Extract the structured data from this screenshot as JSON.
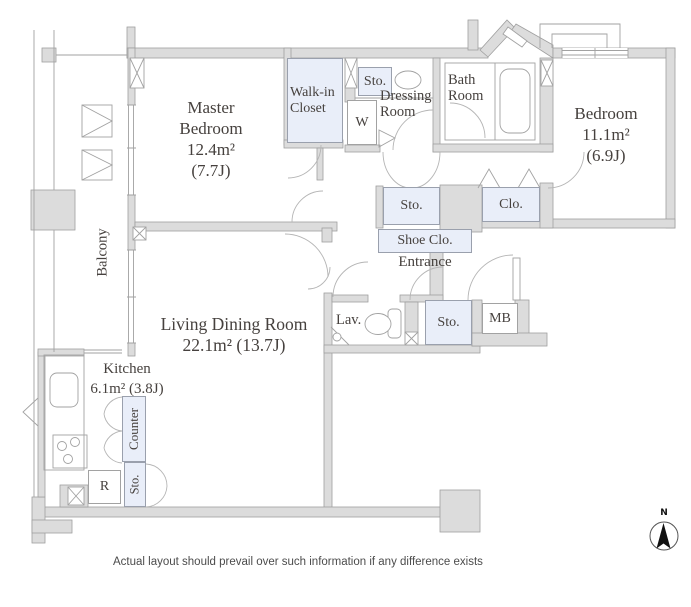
{
  "colors": {
    "wall_fill": "#dcdcdc",
    "wall_stroke": "#9f9f9f",
    "closet_fill": "#e9eef9",
    "line": "#a2a2a2",
    "text": "#46413e"
  },
  "rooms": {
    "master_bedroom": {
      "line1": "Master",
      "line2": "Bedroom",
      "area": "12.4m²",
      "tatami": "(7.7J)"
    },
    "bedroom": {
      "name": "Bedroom",
      "area": "11.1m²",
      "tatami": "(6.9J)"
    },
    "living_dining": {
      "name": "Living Dining Room",
      "area": "22.1m²  (13.7J)"
    },
    "kitchen": {
      "name": "Kitchen",
      "area": "6.1m²  (3.8J)"
    },
    "walk_in_closet": {
      "line1": "Walk-in",
      "line2": "Closet"
    },
    "dressing_room": {
      "line1": "Dressing",
      "line2": "Room"
    },
    "bath_room": {
      "line1": "Bath",
      "line2": "Room"
    },
    "balcony": {
      "name": "Balcony"
    },
    "entrance": {
      "name": "Entrance"
    },
    "lavatory": {
      "name": "Lav."
    }
  },
  "fixtures": {
    "storage_upper": "Sto.",
    "washer": "W",
    "storage_hall": "Sto.",
    "closet": "Clo.",
    "shoe_closet": "Shoe Clo.",
    "storage_entrance": "Sto.",
    "meter_box": "MB",
    "counter": "Counter",
    "storage_kitchen": "Sto.",
    "refrigerator": "R"
  },
  "compass": {
    "north": "N"
  },
  "footer": {
    "disclaimer": "Actual layout should prevail over such information if any difference exists"
  }
}
